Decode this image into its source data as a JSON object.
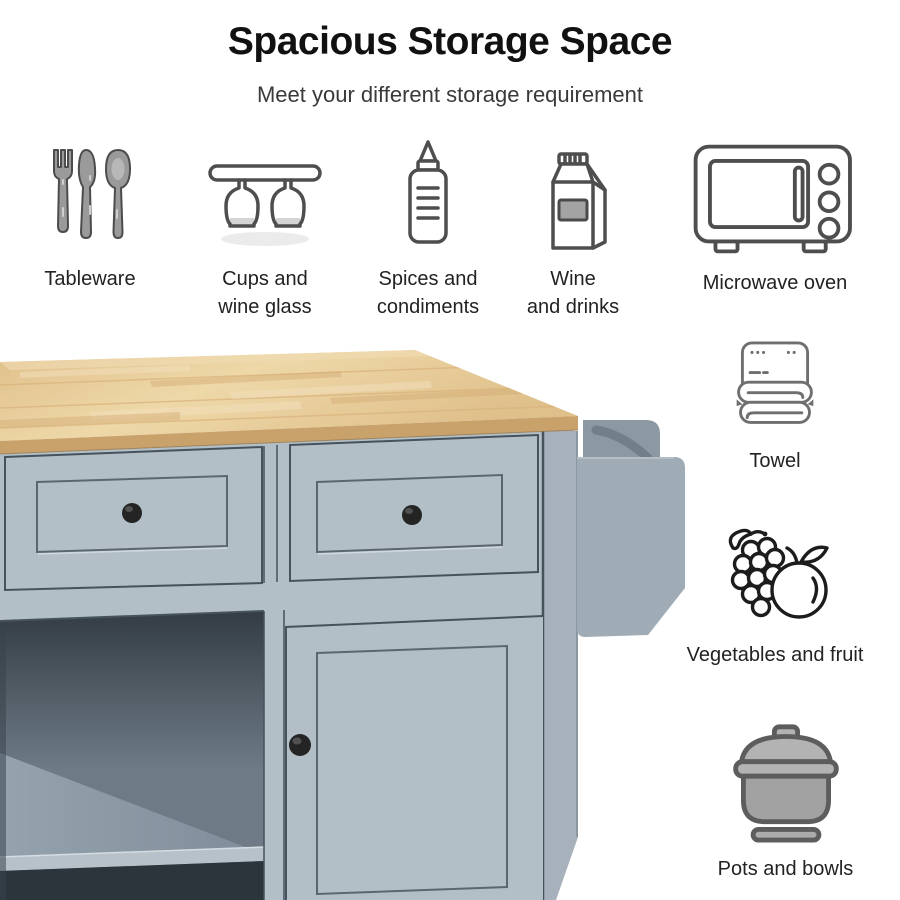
{
  "header": {
    "title": "Spacious Storage Space",
    "subtitle": "Meet your different storage requirement"
  },
  "features_top": [
    {
      "label": "Tableware",
      "icon": "cutlery-icon"
    },
    {
      "label": "Cups and\nwine glass",
      "icon": "wine-glass-rack-icon"
    },
    {
      "label": "Spices and\ncondiments",
      "icon": "squeeze-bottle-icon"
    },
    {
      "label": "Wine\nand drinks",
      "icon": "drink-carton-icon"
    },
    {
      "label": "Microwave oven",
      "icon": "microwave-icon"
    }
  ],
  "features_side": [
    {
      "label": "Towel",
      "icon": "folded-towel-icon"
    },
    {
      "label": "Vegetables and fruit",
      "icon": "grapes-and-fruit-icon"
    },
    {
      "label": "Pots and bowls",
      "icon": "cooking-pot-icon"
    }
  ],
  "product": {
    "alt": "Grey-blue kitchen island cart with natural wood countertop, two drawers with round black knobs, open shelf compartment, cabinet door and side towel rack"
  },
  "colors": {
    "title_text": "#111111",
    "subtitle_text": "#3a3a3a",
    "label_text": "#222222",
    "wood_light": "#eed8a8",
    "wood_mid": "#dfbf8a",
    "wood_dark": "#c9a26b",
    "cabinet_face": "#b3bfc7",
    "cabinet_side": "#a6b1bb",
    "seam": "#46525c",
    "panel_line": "#5a6771",
    "interior_dark": "#333c44",
    "interior_mid": "#6e7b86",
    "floor": "#95a3ae",
    "shelf_edge": "#b6c1c9",
    "interior_bottom": "#2c343c",
    "knob": "#242424",
    "rack": "#9fabb5",
    "rack_bracket": "#8c98a2",
    "rod": "#727e88",
    "icon_stroke": "#4e4e4e",
    "icon_gray": "#9a9a9a",
    "pot_stroke": "#5d5d5d",
    "fruit_stroke": "#1c1c1c"
  }
}
